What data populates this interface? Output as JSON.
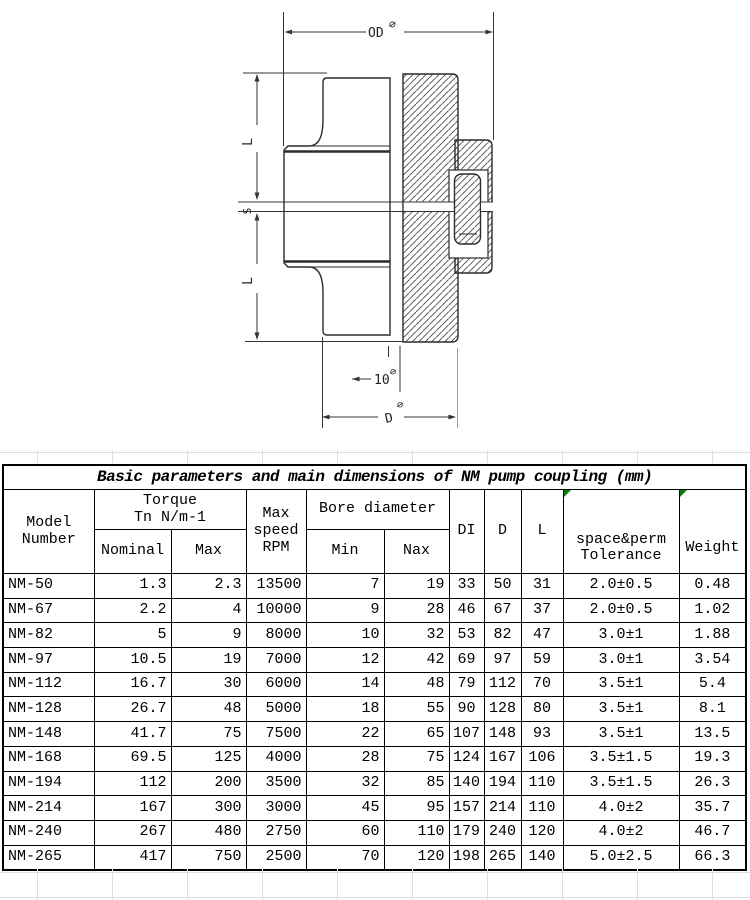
{
  "drawing": {
    "labels": {
      "od": "OD",
      "phi": "∅",
      "l_upper": "L",
      "s": "S",
      "l_lower": "L",
      "ten": "10",
      "d": "D"
    }
  },
  "table": {
    "title": "Basic parameters and main dimensions of NM pump coupling (mm)",
    "headers": {
      "model": "Model\nNumber",
      "torque": "Torque\nTn  N/m-1",
      "nominal": "Nominal",
      "max": "Max",
      "speed": "Max\nspeed\nRPM",
      "bore": "Bore diameter",
      "min": "Min",
      "nax": "Nax",
      "di": "DI",
      "d": "D",
      "l": "L",
      "tolerance": "space&perm\nTolerance",
      "weight": "Weight"
    },
    "rows": [
      [
        "NM-50",
        "1.3",
        "2.3",
        "13500",
        "7",
        "19",
        "33",
        "50",
        "31",
        "2.0±0.5",
        "0.48"
      ],
      [
        "NM-67",
        "2.2",
        "4",
        "10000",
        "9",
        "28",
        "46",
        "67",
        "37",
        "2.0±0.5",
        "1.02"
      ],
      [
        "NM-82",
        "5",
        "9",
        "8000",
        "10",
        "32",
        "53",
        "82",
        "47",
        "3.0±1",
        "1.88"
      ],
      [
        "NM-97",
        "10.5",
        "19",
        "7000",
        "12",
        "42",
        "69",
        "97",
        "59",
        "3.0±1",
        "3.54"
      ],
      [
        "NM-112",
        "16.7",
        "30",
        "6000",
        "14",
        "48",
        "79",
        "112",
        "70",
        "3.5±1",
        "5.4"
      ],
      [
        "NM-128",
        "26.7",
        "48",
        "5000",
        "18",
        "55",
        "90",
        "128",
        "80",
        "3.5±1",
        "8.1"
      ],
      [
        "NM-148",
        "41.7",
        "75",
        "7500",
        "22",
        "65",
        "107",
        "148",
        "93",
        "3.5±1",
        "13.5"
      ],
      [
        "NM-168",
        "69.5",
        "125",
        "4000",
        "28",
        "75",
        "124",
        "167",
        "106",
        "3.5±1.5",
        "19.3"
      ],
      [
        "NM-194",
        "112",
        "200",
        "3500",
        "32",
        "85",
        "140",
        "194",
        "110",
        "3.5±1.5",
        "26.3"
      ],
      [
        "NM-214",
        "167",
        "300",
        "3000",
        "45",
        "95",
        "157",
        "214",
        "110",
        "4.0±2",
        "35.7"
      ],
      [
        "NM-240",
        "267",
        "480",
        "2750",
        "60",
        "110",
        "179",
        "240",
        "120",
        "4.0±2",
        "46.7"
      ],
      [
        "NM-265",
        "417",
        "750",
        "2500",
        "70",
        "120",
        "198",
        "265",
        "140",
        "5.0±2.5",
        "66.3"
      ]
    ],
    "marker_color": "#0b7c0b"
  }
}
